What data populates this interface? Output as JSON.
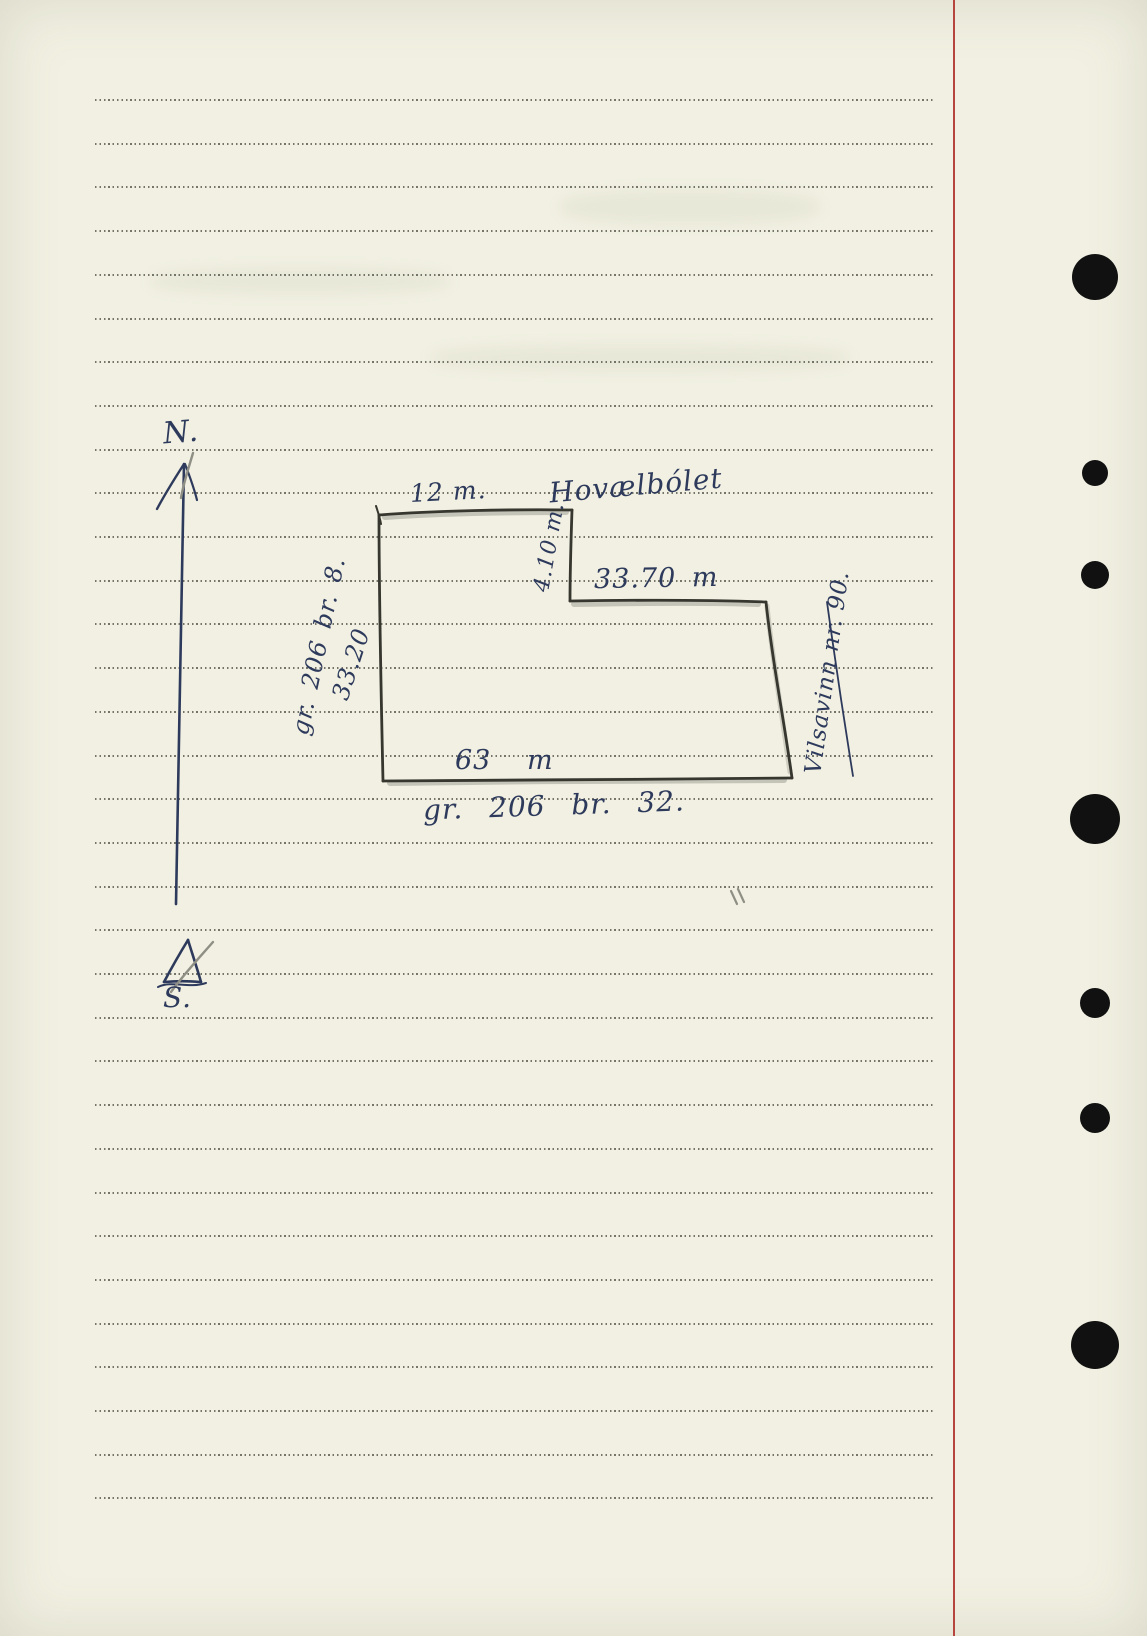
{
  "page": {
    "width": 1147,
    "height": 1636,
    "background": "#f1f0e2"
  },
  "paper": {
    "ruled_lines": {
      "count": 33,
      "top": 99,
      "spacing": 43.7,
      "color": "#55554b"
    },
    "margin_line": {
      "x": 953,
      "color": "#b5453e"
    },
    "punch_hole_x": 1095,
    "punch_hole_color": "#111111",
    "punch_holes": [
      {
        "y": 277,
        "r": 23
      },
      {
        "y": 473,
        "r": 13
      },
      {
        "y": 575,
        "r": 14
      },
      {
        "y": 819,
        "r": 25
      },
      {
        "y": 1003,
        "r": 15
      },
      {
        "y": 1118,
        "r": 15
      },
      {
        "y": 1345,
        "r": 24
      }
    ]
  },
  "sketch": {
    "ink_color": "#2e3a5c",
    "pencil_color": "#8f8f85",
    "outline_color": "#37362f",
    "compass": {
      "north_label": "N.",
      "south_label": "S."
    },
    "plot": {
      "top_width_label": "12 m.",
      "place_name": "Hovælbólet",
      "step_label": "4.10 m.",
      "upper_right_width_label": "33.70 m",
      "bottom_width_label": "63 m",
      "bottom_parcel_label": "gr. 206 br. 32.",
      "left_parcel_label": "gr. 206 br. 8.",
      "left_length_label": "33.20",
      "road_label": "Vilsavinn nr. 90."
    }
  }
}
